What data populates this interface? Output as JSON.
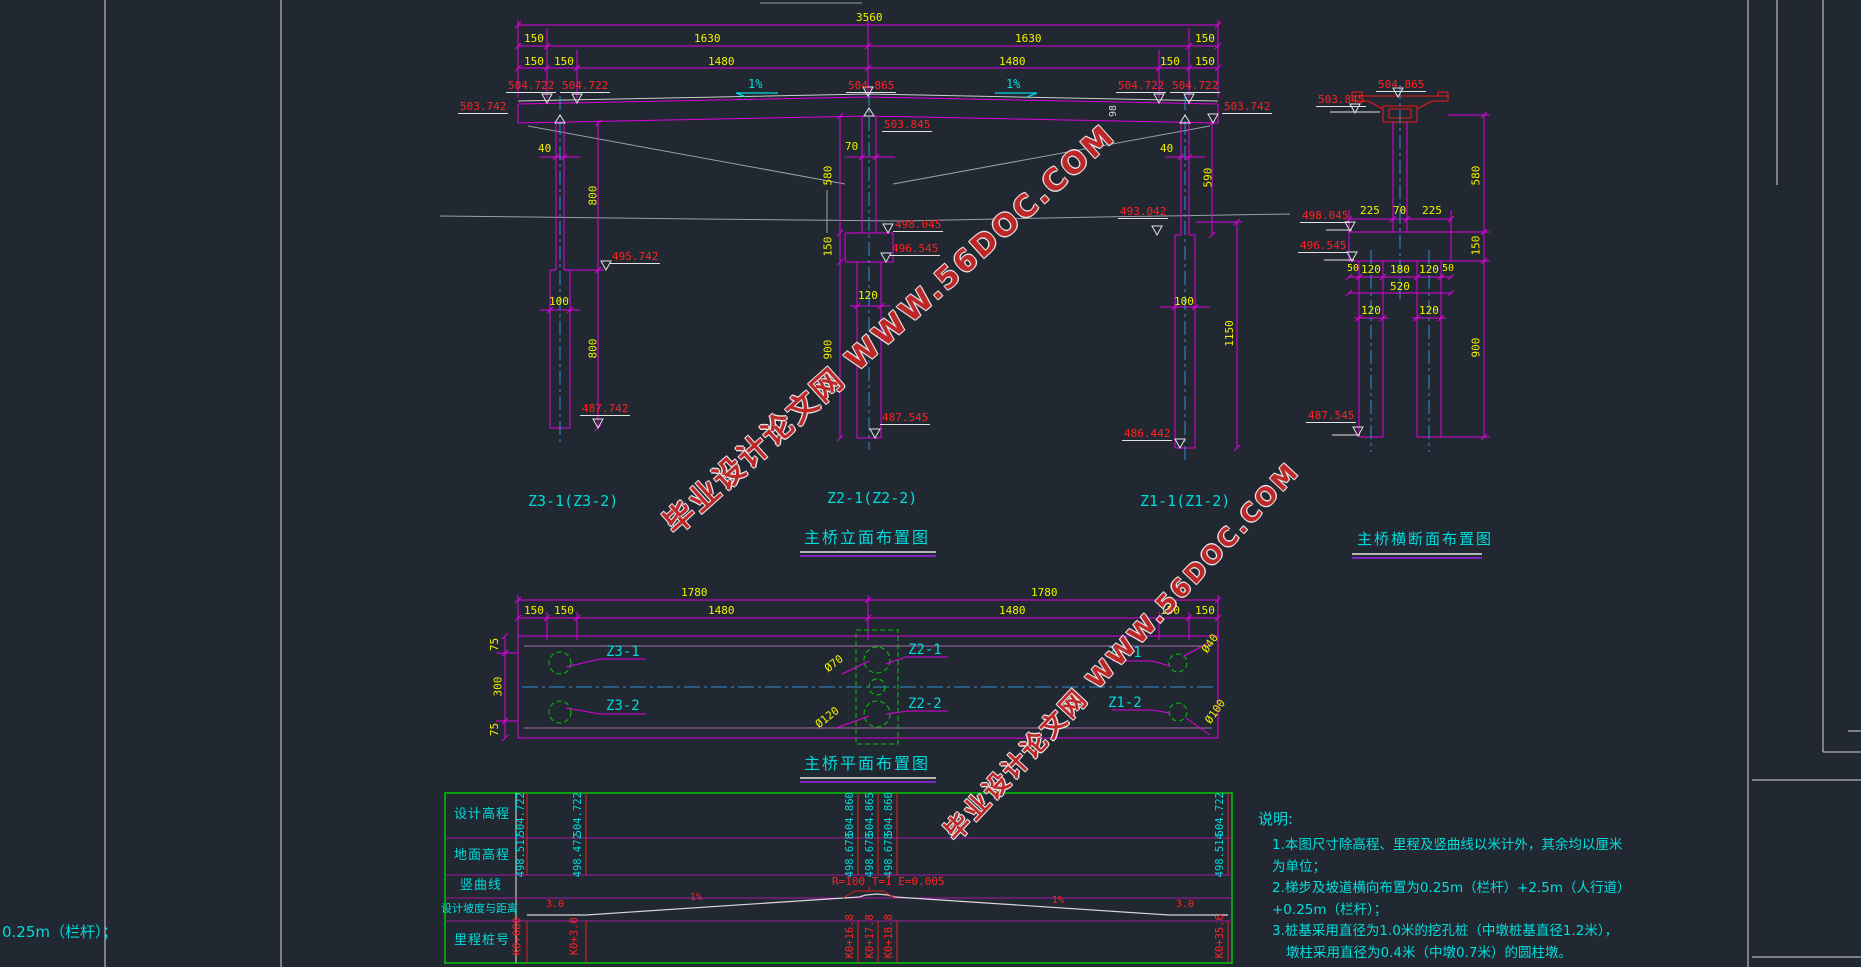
{
  "watermark": {
    "site": "毕业设计论文网",
    "url": "WWW.56DOC.COM"
  },
  "stray_text": "0.25m（栏杆）；",
  "elevation_view": {
    "title": "主桥立面布置图",
    "dims": {
      "total": "3560",
      "span": "1630",
      "end": "150",
      "clear": "1480"
    },
    "deck": {
      "elev_end": "504.722",
      "elev_mid": "504.865",
      "elev_soffit": "503.742",
      "depth": "98",
      "slope": "1%"
    },
    "z3": {
      "name": "Z3-1(Z3-2)",
      "cap_w": "40",
      "upper_h": "800",
      "col_w": "100",
      "lower_h": "800",
      "elev_step": "495.742",
      "elev_base": "487.742"
    },
    "z2": {
      "name": "Z2-1(Z2-2)",
      "cap_w": "70",
      "upper_h": "580",
      "cap_h": "150",
      "col_w": "120",
      "lower_h": "900",
      "elev_top": "503.845",
      "elev_cap_top": "498.045",
      "elev_cap_bot": "496.545",
      "elev_base": "487.545"
    },
    "z1": {
      "name": "Z1-1(Z1-2)",
      "cap_w": "40",
      "upper_h": "590",
      "col_w": "100",
      "lower_h": "1150",
      "elev_step": "493.042",
      "elev_base": "486.442"
    }
  },
  "cross_section": {
    "title": "主桥横断面布置图",
    "elev_top": "504.865",
    "elev_soffit": "503.845",
    "elev_cap_top": "498.045",
    "elev_cap_bot": "496.545",
    "elev_base": "487.545",
    "side": "225",
    "stem_w": "70",
    "upper_h": "580",
    "cap_h": "150",
    "edge": "50",
    "pile_w": "120",
    "gap": "180",
    "cap_w": "520",
    "lower_h": "900"
  },
  "plan_view": {
    "title": "主桥平面布置图",
    "dims": {
      "half": "1780",
      "end": "150",
      "clear": "1480",
      "edge": "75",
      "mid": "300"
    },
    "piles": {
      "z31": "Z3-1",
      "z32": "Z3-2",
      "z21": "Z2-1",
      "z22": "Z2-2",
      "z11": "Z1-1",
      "z12": "Z1-2"
    },
    "dia": {
      "mid_top": "Ø70",
      "mid_bot": "Ø120",
      "end_top": "Ø40",
      "end_bot": "Ø100"
    }
  },
  "profile_table": {
    "headers": {
      "h1": "设计高程",
      "h2": "地面高程",
      "h3": "竖曲线",
      "h4": "设计坡度与距离",
      "h5": "里程桩号"
    },
    "design": [
      "504.722",
      "504.722",
      "504.860",
      "504.865",
      "504.860",
      "504.722"
    ],
    "ground": [
      "498.517",
      "498.472",
      "498.678",
      "498.678",
      "498.678",
      "498.514"
    ],
    "vcurve": "R=100 T=1 E=0.005",
    "flat": "3.0",
    "grade": "1%",
    "stations": [
      "K0+000",
      "K0+3.0",
      "K0+16.8",
      "K0+17.8",
      "K0+18.8",
      "K0+35.6"
    ]
  },
  "notes": {
    "title": "说明:",
    "items": [
      "1.本图尺寸除高程、里程及竖曲线以米计外，其余均以厘米为单位；",
      "2.梯步及坡道横向布置为0.25m（栏杆）+2.5m（人行道）+0.25m（栏杆）；",
      "3.桩基采用直径为1.0米的挖孔桩（中墩桩基直径1.2米），",
      "墩柱采用直径为0.4米（中墩0.7米）的圆柱墩。"
    ]
  }
}
